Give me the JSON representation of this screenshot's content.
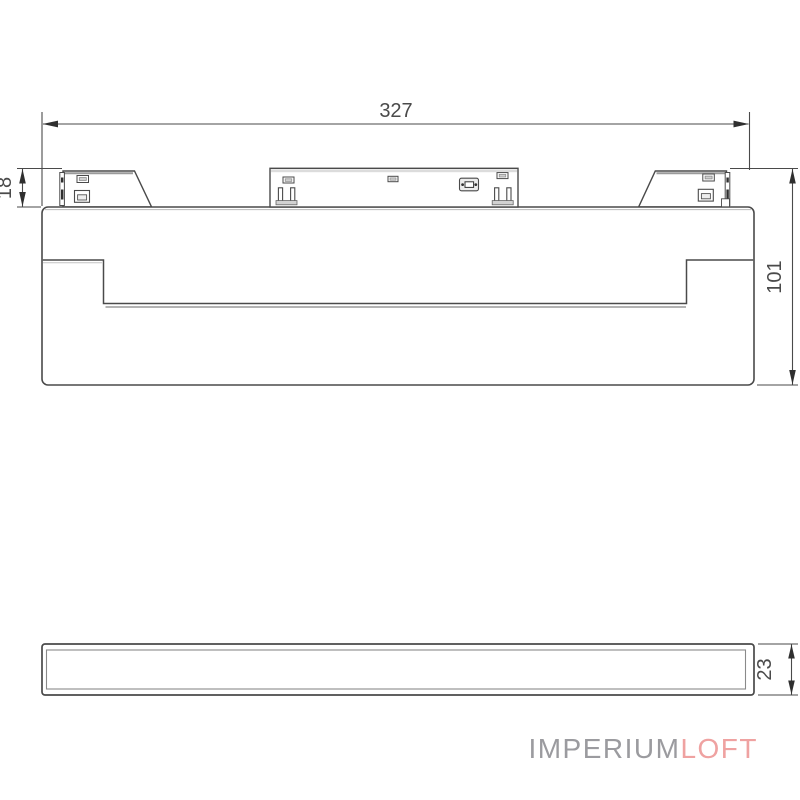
{
  "drawing": {
    "dimensions": {
      "width_mm": "327",
      "total_height_mm": "101",
      "connector_height_mm": "18",
      "profile_height_mm": "23"
    },
    "line_color": "#4a4a4a",
    "shadow_line_color": "#9a9a9a"
  },
  "logo": {
    "primary": "IMPERIUM",
    "secondary": "LOFT",
    "primary_color": "#9b9b9f",
    "secondary_color": "#efa2a1"
  }
}
